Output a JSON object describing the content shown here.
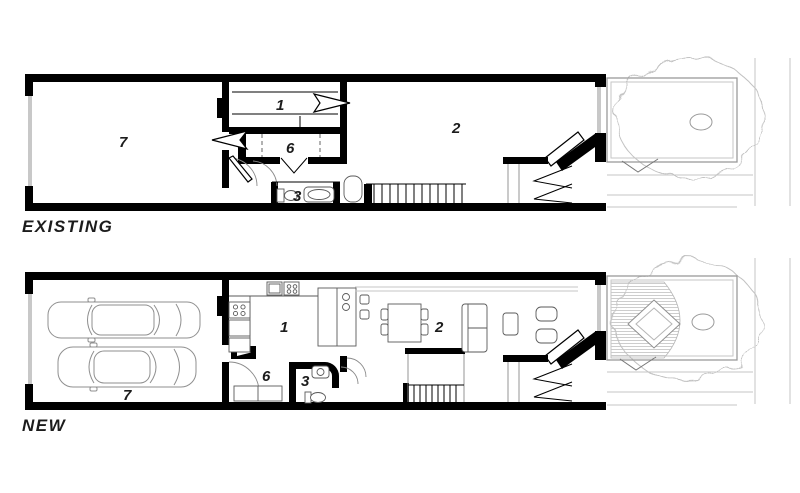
{
  "drawing_title": "Row house floor plans comparison",
  "colors": {
    "wall": "#000000",
    "interior_line": "#5a5a5a",
    "site_line": "#c6c6c6",
    "tree_line": "#c2c2c2",
    "garage_opening": "#c8c8c8",
    "text": "#1c1c1c",
    "background": "#ffffff"
  },
  "plans": [
    {
      "label": "EXISTING",
      "rooms": [
        {
          "number": "7"
        },
        {
          "number": "1"
        },
        {
          "number": "6"
        },
        {
          "number": "2"
        },
        {
          "number": "3"
        }
      ]
    },
    {
      "label": "NEW",
      "rooms": [
        {
          "number": "7"
        },
        {
          "number": "1"
        },
        {
          "number": "6"
        },
        {
          "number": "3"
        },
        {
          "number": "2"
        }
      ]
    }
  ]
}
